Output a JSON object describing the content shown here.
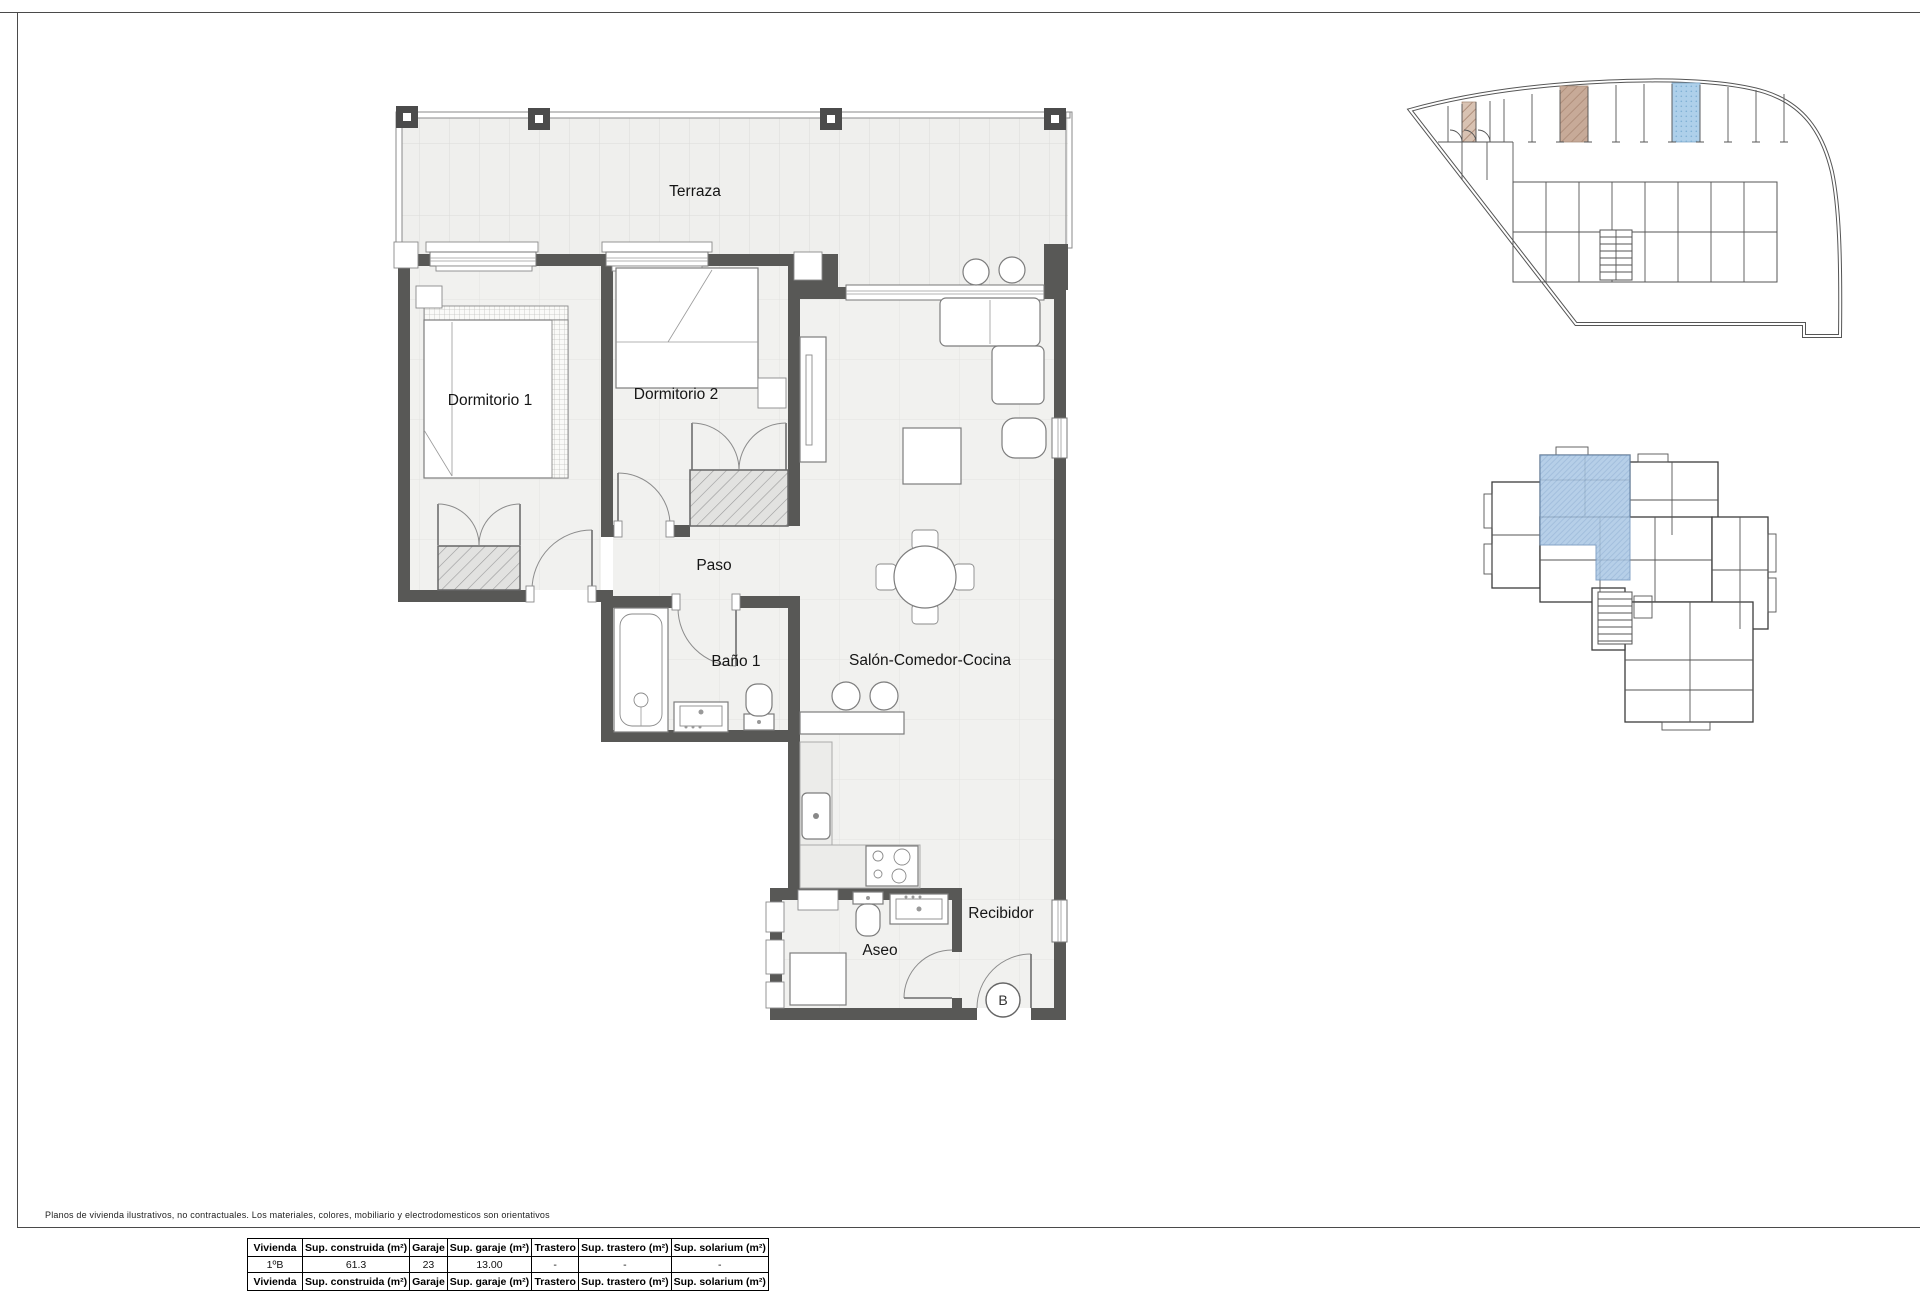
{
  "floor_plan": {
    "labels": {
      "terraza": "Terraza",
      "dormitorio1": "Dormitorio 1",
      "dormitorio2": "Dormitorio 2",
      "paso": "Paso",
      "bano1": "Baño 1",
      "salon": "Salón-Comedor-Cocina",
      "aseo": "Aseo",
      "recibidor": "Recibidor",
      "unit_marker": "B"
    }
  },
  "footer": {
    "disclaimer": "Planos de vivienda ilustrativos, no contractuales. Los materiales, colores, mobiliario y electrodomesticos son orientativos"
  },
  "table": {
    "headers": [
      "Vivienda",
      "Sup. construida (m²)",
      "Garaje",
      "Sup. garaje (m²)",
      "Trastero",
      "Sup. trastero (m²)",
      "Sup. solarium (m²)"
    ],
    "rows": [
      [
        "1ºB",
        "61.3",
        "23",
        "13.00",
        "-",
        "-",
        "-"
      ]
    ]
  },
  "colors": {
    "wall": "#585856",
    "highlight_blue": "#aed0ea",
    "highlight_brown": "#c7aa98",
    "highlight_tan": "#d8c2b2",
    "key_plan_blue": "#aac7e4"
  }
}
